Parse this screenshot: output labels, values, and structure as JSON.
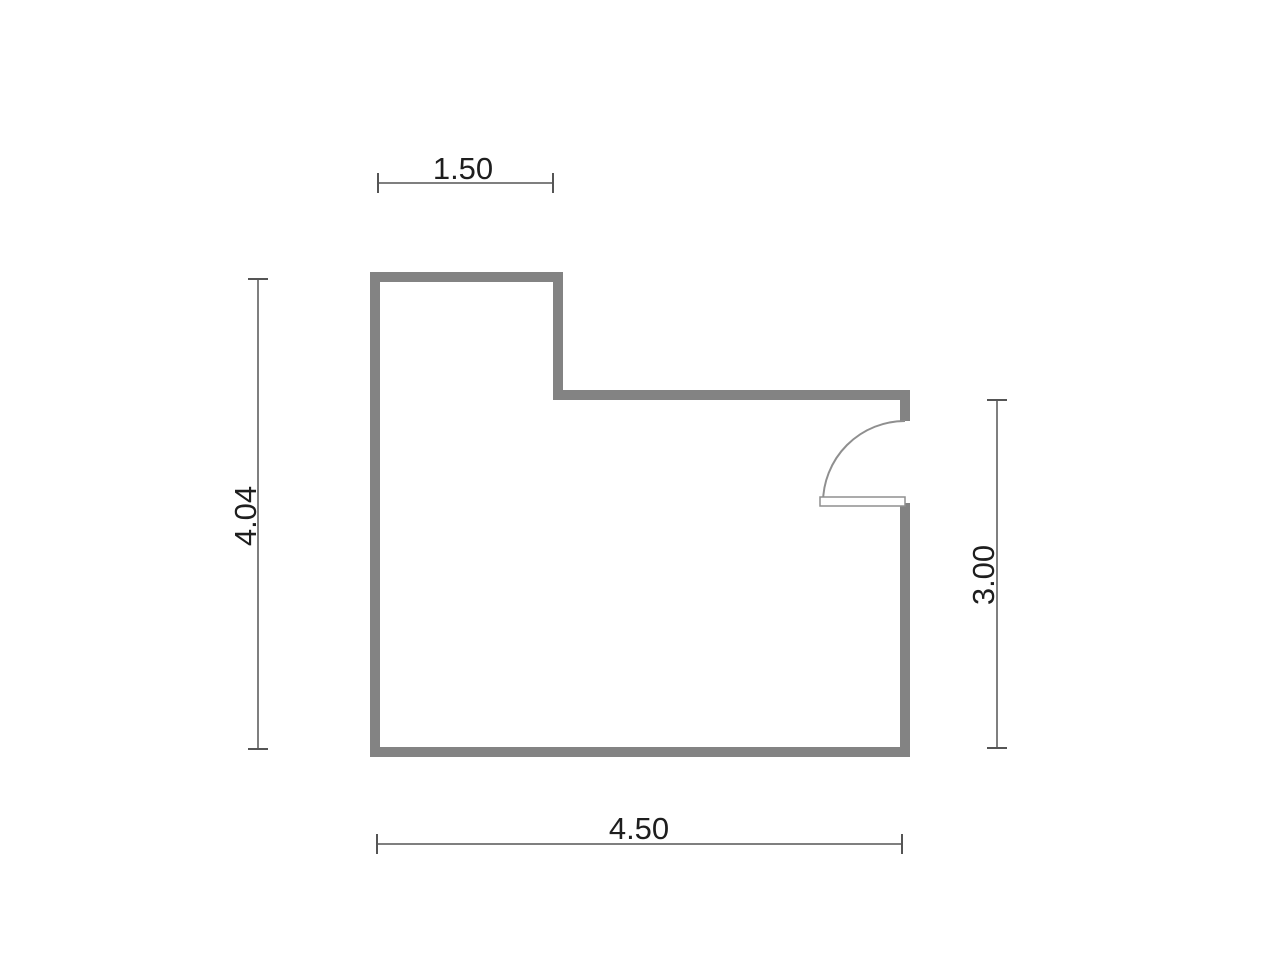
{
  "floorplan": {
    "dimensions": {
      "top": "1.50",
      "left": "4.04",
      "right": "3.00",
      "bottom": "4.50"
    },
    "door": {
      "location": "right-wall",
      "type": "single-swing"
    },
    "colors": {
      "background": "#ffffff",
      "wall": "#838383",
      "door": "#8f8f8f",
      "door_fill": "#ffffff",
      "dimension": "#555555",
      "label": "#1e1e1e"
    }
  }
}
